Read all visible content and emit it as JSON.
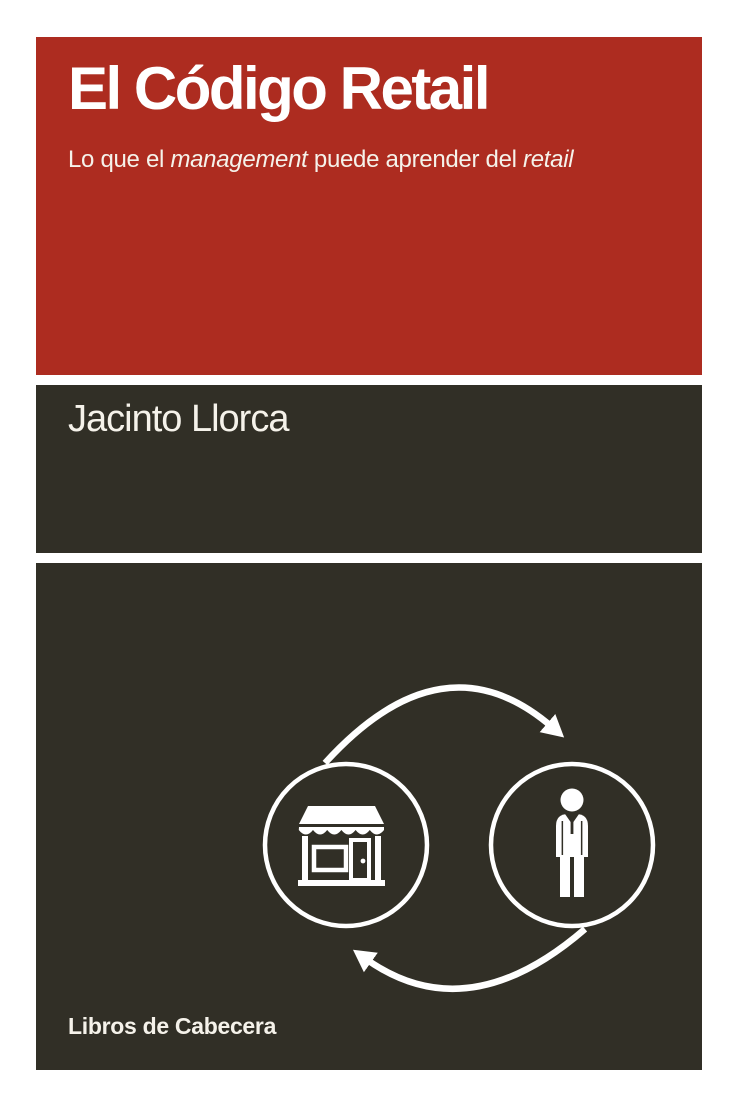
{
  "cover": {
    "title": "El Código Retail",
    "subtitle": {
      "part1": "Lo que el ",
      "part2_italic": "management",
      "part3": " puede aprender del ",
      "part4_italic": "retail"
    },
    "author": "Jacinto Llorca",
    "publisher": "Libros de Cabecera"
  },
  "colors": {
    "red": "#AD2C20",
    "dark": "#312F26",
    "background": "#FFFFFF",
    "white": "#FFFFFF",
    "text_light": "#F5F2EA"
  },
  "diagram": {
    "left_icon": "storefront-icon",
    "right_icon": "businessman-icon",
    "arrows": [
      "cycle-arrow-top",
      "cycle-arrow-bottom"
    ]
  }
}
